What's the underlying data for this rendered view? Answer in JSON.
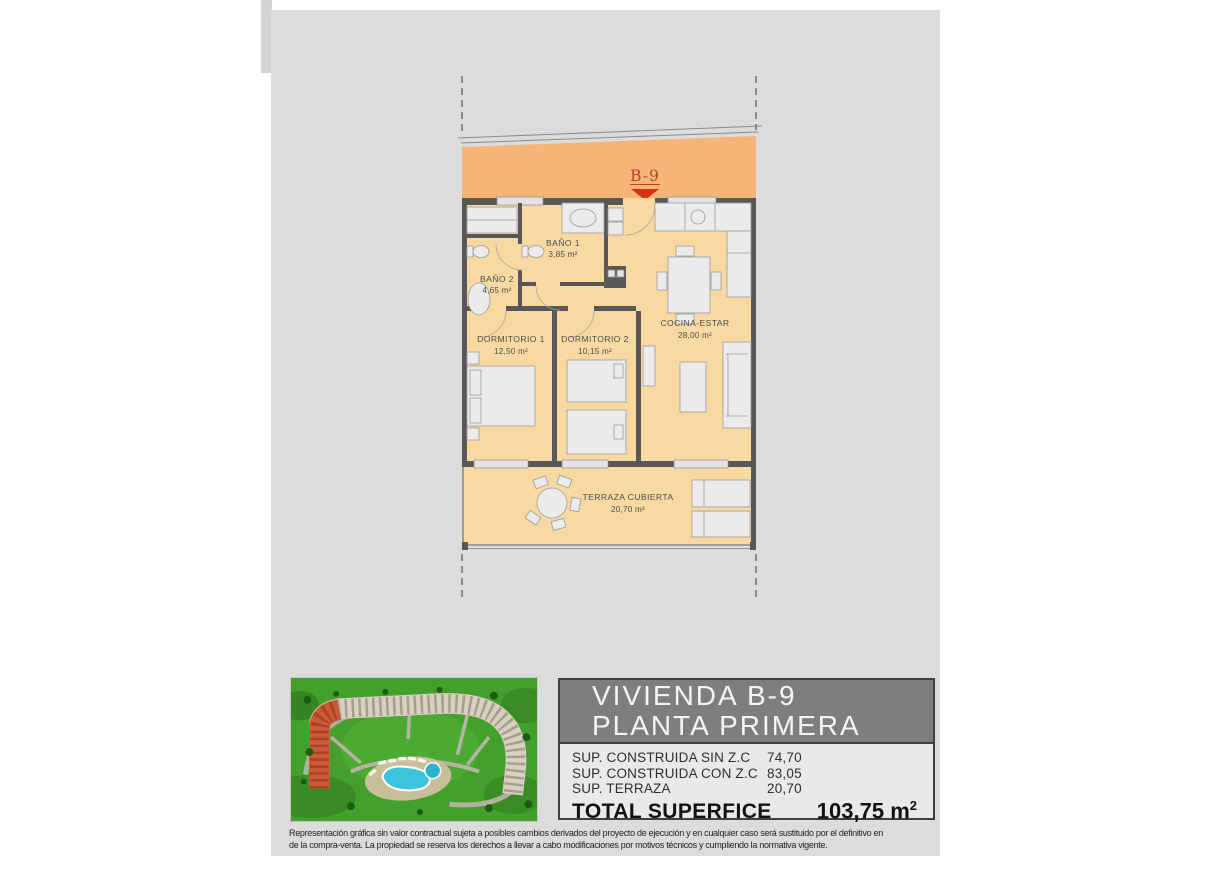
{
  "theme": {
    "band": "#f7b477",
    "floor": "#f8d9a2",
    "wall": "#585858",
    "marker": "#b5432a",
    "arrow": "#d33110",
    "sheet": "#dcdcdc",
    "header": "#7e7e7e",
    "info_bg": "#e9e9e9"
  },
  "plan": {
    "unit_label": "B-9",
    "rooms": [
      {
        "name": "BAÑO 1",
        "area": "3,85 m²"
      },
      {
        "name": "BAÑO 2",
        "area": "4,65 m²"
      },
      {
        "name": "DORMITORIO 1",
        "area": "12,50 m²"
      },
      {
        "name": "DORMITORIO 2",
        "area": "10,15 m²"
      },
      {
        "name": "COCINA-ESTAR",
        "area": "28,00 m²"
      },
      {
        "name": "TERRAZA CUBIERTA",
        "area": "20,70 m²"
      }
    ]
  },
  "site_plan": {
    "description": "aerial render of residential complex with pool, unit block highlighted",
    "highlight_color": "#c8502a",
    "pool_color": "#3cc3de",
    "grass_color": "#43a02c"
  },
  "info_panel": {
    "title_line1": "VIVIENDA B-9",
    "title_line2": "PLANTA PRIMERA",
    "rows": [
      {
        "label": "SUP. CONSTRUIDA SIN Z.C",
        "value": "74,70"
      },
      {
        "label": "SUP. CONSTRUIDA CON Z.C",
        "value": "83,05"
      },
      {
        "label": "SUP. TERRAZA",
        "value": "20,70"
      }
    ],
    "total_label": "TOTAL SUPERFICE",
    "total_value": "103,75 m",
    "total_value_sup": "2"
  },
  "disclaimer": {
    "line1": "Representación gráfica sin valor contractual sujeta a posibles cambios derivados del proyecto de ejecución y en cualquier caso será sustituido por el definitivo en",
    "line2": "de la compra-venta. La propiedad se reserva los derechos a llevar a cabo modificaciones por motivos técnicos y cumpliendo la normativa vigente."
  }
}
